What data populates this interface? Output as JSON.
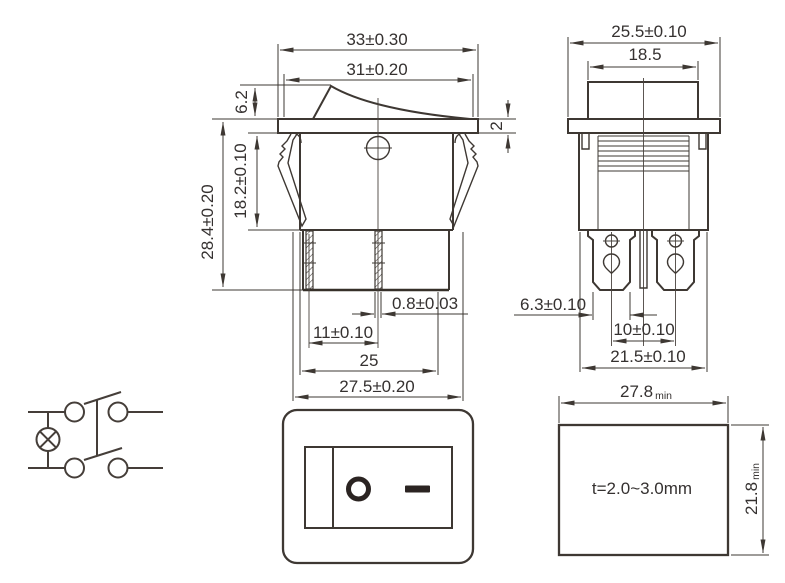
{
  "title": "Rocker switch technical drawing",
  "colors": {
    "line": "#3e3833",
    "text": "#353130",
    "marking": "#2b2422",
    "background": "#ffffff"
  },
  "side_view": {
    "dim_width_overall": "33±0.30",
    "dim_width_rocker": "31±0.20",
    "dim_rocker_height": "6.2",
    "dim_flange_thickness": "2",
    "dim_body_height": "18.2±0.10",
    "dim_overall_height": "28.4±0.20",
    "dim_terminal_thickness": "0.8±0.03",
    "dim_terminal_offset": "11±0.10",
    "dim_base_width": "25",
    "dim_body_width": "27.5±0.20"
  },
  "front_view": {
    "dim_flange_width": "25.5±0.10",
    "dim_rocker_width": "18.5",
    "dim_terminal_blade_width": "6.3±0.10",
    "dim_terminal_pitch": "10±0.10",
    "dim_body_width": "21.5±0.10"
  },
  "panel_cutout": {
    "dim_cutout_width": "27.8",
    "dim_cutout_width_suffix": "min",
    "dim_cutout_height": "21.8",
    "dim_cutout_height_suffix": "min",
    "panel_thickness_note": "t=2.0~3.0mm"
  },
  "front_face": {
    "off_symbol": "O",
    "on_symbol": "—"
  }
}
